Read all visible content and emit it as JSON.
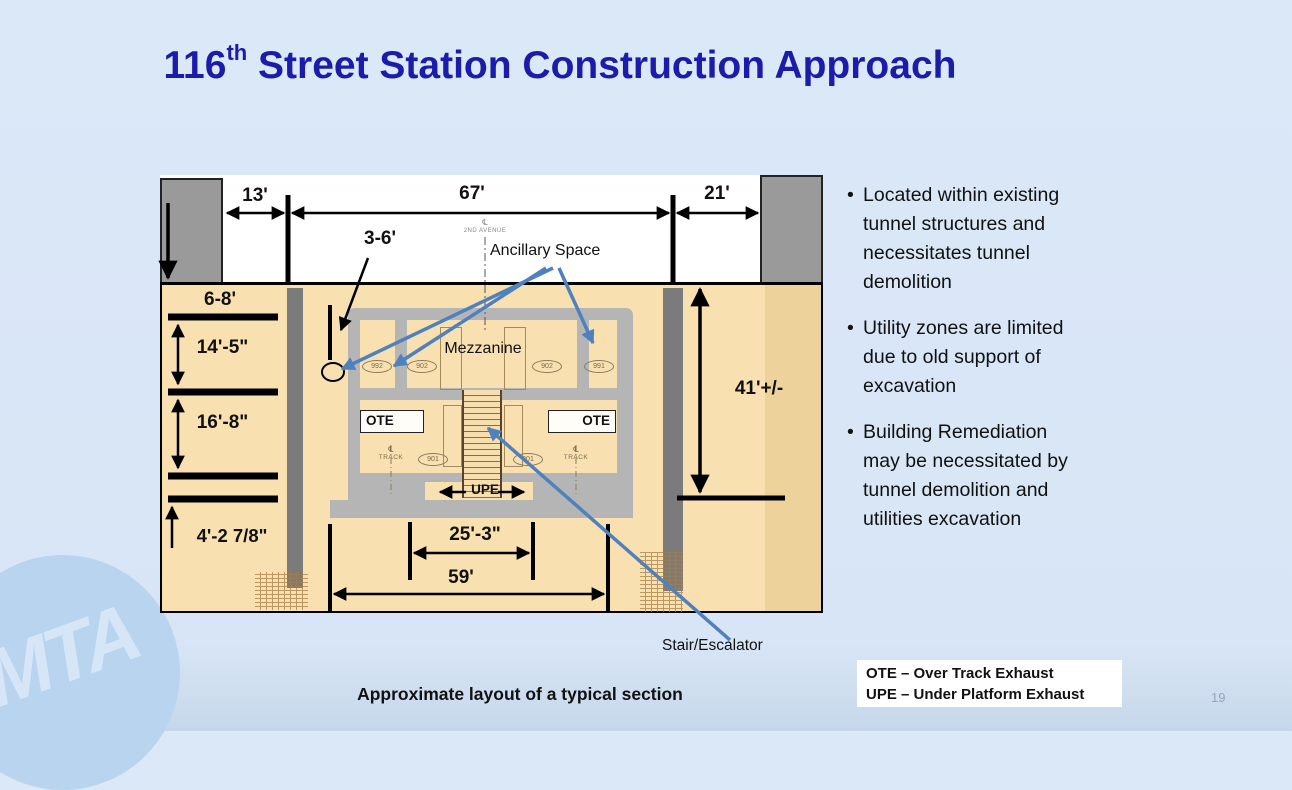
{
  "slide": {
    "title": {
      "number": "116",
      "ordinal": "th",
      "rest": " Street Station Construction Approach"
    },
    "caption": "Approximate layout of a typical section",
    "page_number": "19",
    "logo_text": "MTA"
  },
  "bullets": [
    "Located within existing tunnel structures and necessitates tunnel demolition",
    "Utility zones are limited due to old support of excavation",
    "Building Remediation may be necessitated by tunnel demolition and utilities excavation"
  ],
  "legend": {
    "line1": "OTE – Over Track Exhaust",
    "line2": "UPE – Under Platform Exhaust"
  },
  "diagram": {
    "dims": {
      "street_left": "13'",
      "street_center": "67'",
      "street_right": "21'",
      "offset": "3-6'",
      "cover": "6-8'",
      "mezz_height": "14'-5\"",
      "platform_height": "16'-8\"",
      "invert": "4'-2 7/8\"",
      "depth": "41'+/-",
      "inner_width": "25'-3\"",
      "outer_width": "59'"
    },
    "labels": {
      "ancillary": "Ancillary Space",
      "mezzanine": "Mezzanine",
      "stair": "Stair/Escalator",
      "ote": "OTE",
      "upe": "UPE",
      "centerline_symbol": "℄",
      "avenue": "2ND AVENUE",
      "track": "TRACK"
    },
    "rooms": {
      "mezz": [
        "992",
        "902",
        "902",
        "991"
      ],
      "platform": [
        "901",
        "901"
      ]
    }
  },
  "colors": {
    "background": "#d9e6f6",
    "title": "#1c1caa",
    "earth": "#f8e0b1",
    "earth_shade": "#edd29b",
    "structure_gray": "#b5b5b5",
    "pile_gray": "#7b7b7b",
    "building_gray": "#9a9a9a",
    "arrow_blue": "#4f81bd",
    "legend_bg": "#ffffff"
  }
}
